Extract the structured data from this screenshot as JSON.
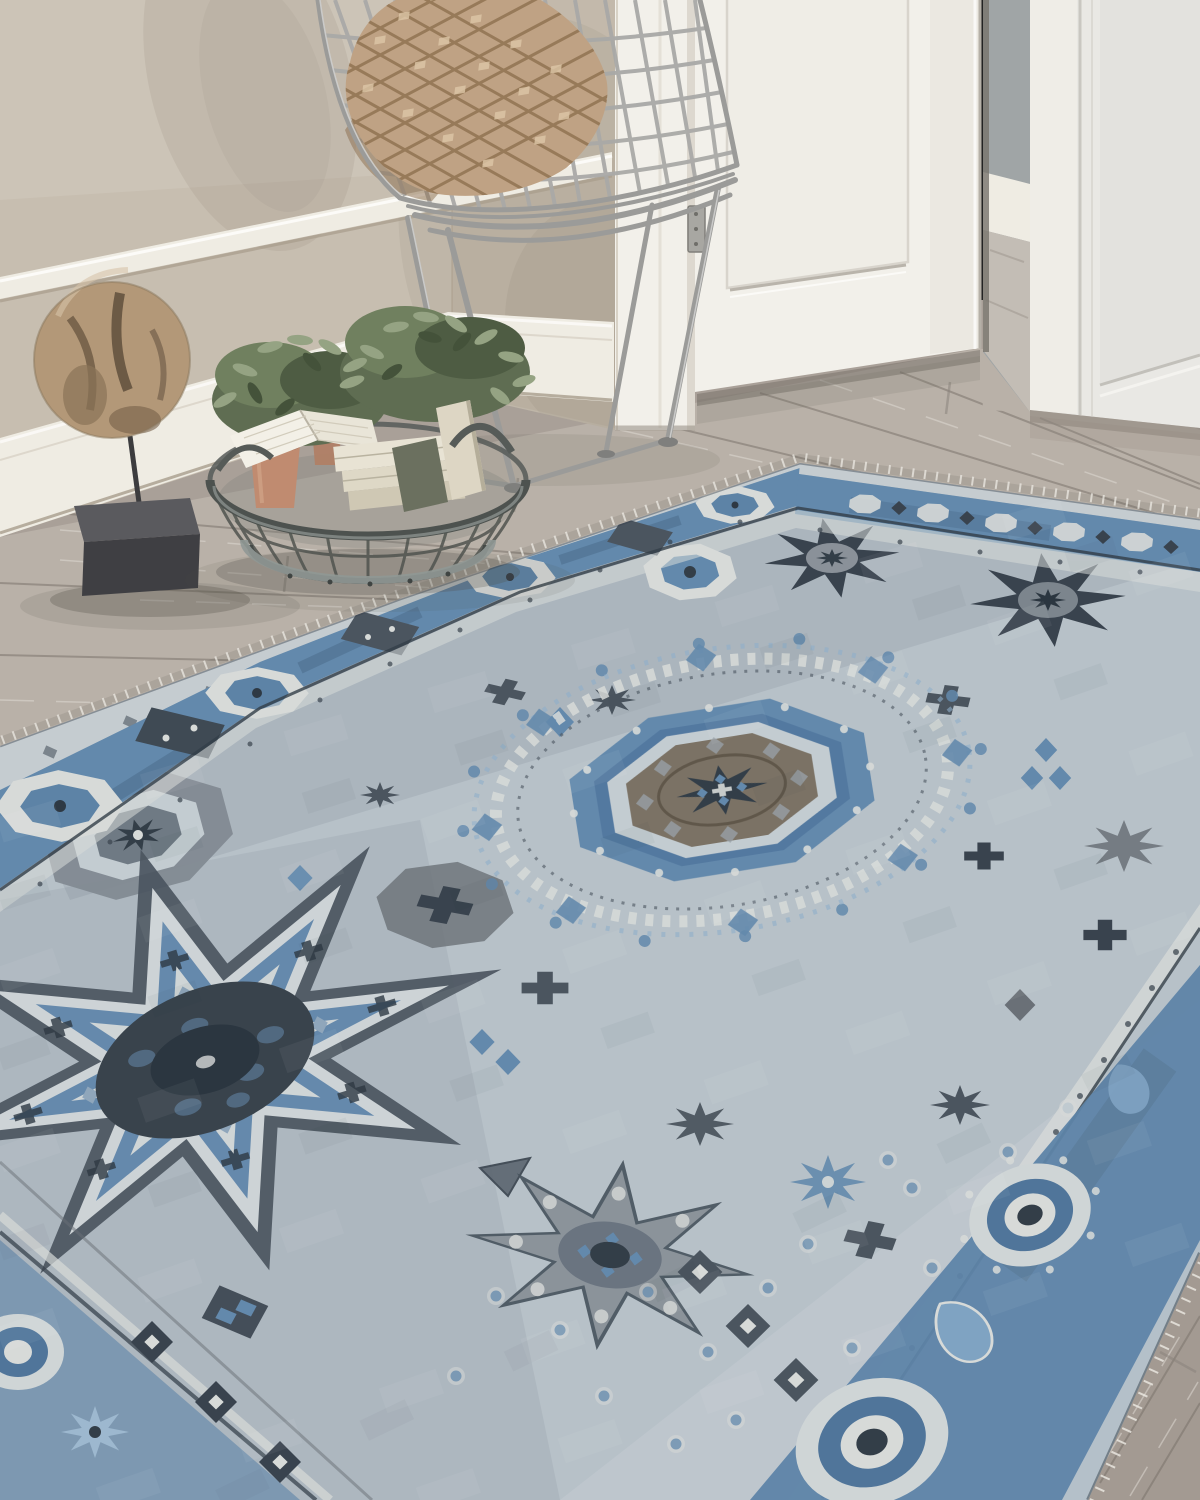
{
  "meta": {
    "type": "photograph",
    "subject": "Blue-grey Mamluk-style area rug styled in an entryway",
    "canvas": "1200x1500"
  },
  "scene": {
    "description": "Lifestyle product photo of a hand-knotted blue and grey Mamluk-pattern area rug with fringe, laid diagonally on grey washed oak plank flooring in an entryway. Behind it: a beige wall with white chair rail and baseboard, a silver bent-wire side chair holding a tan diamond-tufted pillow, a driftwood sphere sculpture on a black stand, a round wire basket holding books, an open book and two terracotta pots with green foliage, an open white panel door with a hinge, a glimpse of a hallway with grey wall and white baseboard, and a second closed white panel door at right.",
    "objects": [
      {
        "name": "area-rug",
        "label": "Blue-grey Mamluk medallion rug with cream fringe"
      },
      {
        "name": "wire-chair",
        "label": "Silver bent-wire side chair"
      },
      {
        "name": "accent-pillow",
        "label": "Tan diamond-tufted accent pillow"
      },
      {
        "name": "wire-basket",
        "label": "Round metal wire basket with galvanized band"
      },
      {
        "name": "books",
        "label": "Cream books and an open book"
      },
      {
        "name": "potted-plants",
        "label": "Terracotta pots with green foliage"
      },
      {
        "name": "driftwood-sculpture",
        "label": "Driftwood sphere on black museum stand"
      },
      {
        "name": "open-door",
        "label": "Open white panel door with silver hinge"
      },
      {
        "name": "hallway",
        "label": "Hallway opening with grey wall and white baseboard"
      },
      {
        "name": "right-door",
        "label": "Closed white panel door"
      },
      {
        "name": "wall",
        "label": "Beige wall with white chair rail and tall baseboard"
      },
      {
        "name": "floor",
        "label": "Grey washed oak plank floor"
      }
    ]
  },
  "rug_design": {
    "style": "Mamluk / Turkish hand-knotted look",
    "field": "light blue-grey",
    "motifs": [
      "central octagonal medallion with taupe-brown core and navy star center",
      "large eight-point star medallion with charcoal center (lower left)",
      "dark eight-point star medallions in upper field",
      "octagon rosette cartouches in border bands",
      "grey eight-lobed rosette (bottom center)",
      "rosette eye roundels in near border",
      "paisley boteh motifs",
      "diamond chains and scattered blue dots"
    ],
    "border": "slate blue bands edged with cream guard stripes and navy dot rows",
    "fringe": "short cream fringe along the far edges"
  },
  "palette": {
    "wall": "#c7beb0",
    "wallLower": "#b9ae9e",
    "trim": "#efece3",
    "trimShadow": "#a89d8c",
    "floor": "#a9a098",
    "floorLight": "#d2ccc4",
    "floorDark": "#8b837b",
    "floorSeam": "#776f67",
    "door": "#f2f0ea",
    "doorShade": "#dbd7cf",
    "doorEdge": "#b5b0a7",
    "hallWall": "#a0a5a6",
    "hallFloor": "#c3bdb5",
    "rightDoor": "#e9e8e4",
    "rightDoorLine": "#c9c7c1",
    "chairWire": "#a9a9a7",
    "chairWireDark": "#7f7f7d",
    "pillowBase": "#bfa284",
    "pillowShade": "#8a6c4b",
    "pillowHighlight": "#ddc7a7",
    "wood": "#b39878",
    "woodDark": "#5f4f3c",
    "woodHighlight": "#d8c5aa",
    "standBase": "#47474b",
    "basketWire": "#50544f",
    "basketBand": "#909895",
    "bookCream": "#e8e3d4",
    "bookLight": "#f3f0e7",
    "potClay": "#c08b70",
    "leaf": "#6f7e5d",
    "leafDark": "#4e5c43",
    "leafLight": "#95a383",
    "rugField": "#b7c1c8",
    "rugFieldLight": "#cbd2d6",
    "rugBlue": "#6389ac",
    "rugBlueLight": "#8fafc9",
    "rugNavy": "#333e48",
    "rugCharcoal": "#4b555f",
    "rugSlate": "#7c858d",
    "rugTaupe": "#90887a",
    "rugBrown": "#7b7265",
    "rugCream": "#d7dad8",
    "fringe": "#eceae3",
    "shadow": "#4e4a44"
  }
}
